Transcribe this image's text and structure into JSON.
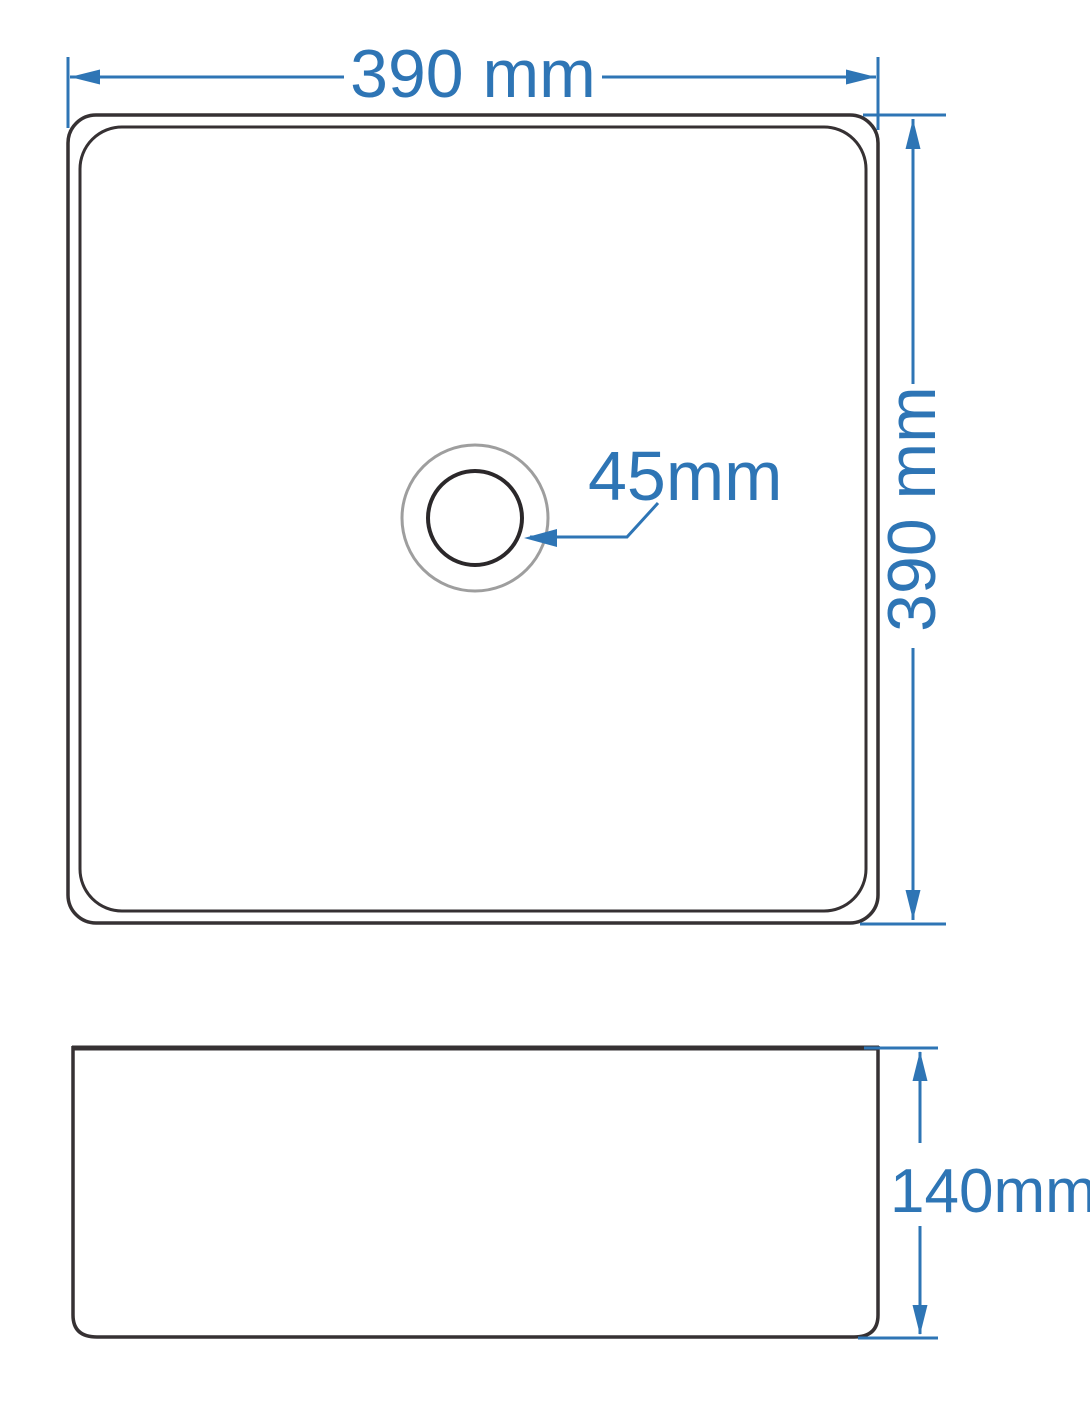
{
  "diagram": {
    "kind": "technical-dimension-drawing",
    "subject": "square vessel basin",
    "unit": "mm",
    "colors": {
      "dimension_blue": "#2E75B5",
      "outline_dark": "#363133",
      "drain_ring_gray": "#9E9E9E",
      "background": "#FFFFFF"
    },
    "top_view": {
      "width_label": "390 mm",
      "height_label": "390 mm",
      "drain_label": "45mm",
      "width_mm": 390,
      "height_mm": 390,
      "drain_diameter_mm": 45
    },
    "side_view": {
      "height_label": "140mm",
      "height_mm": 140
    }
  }
}
